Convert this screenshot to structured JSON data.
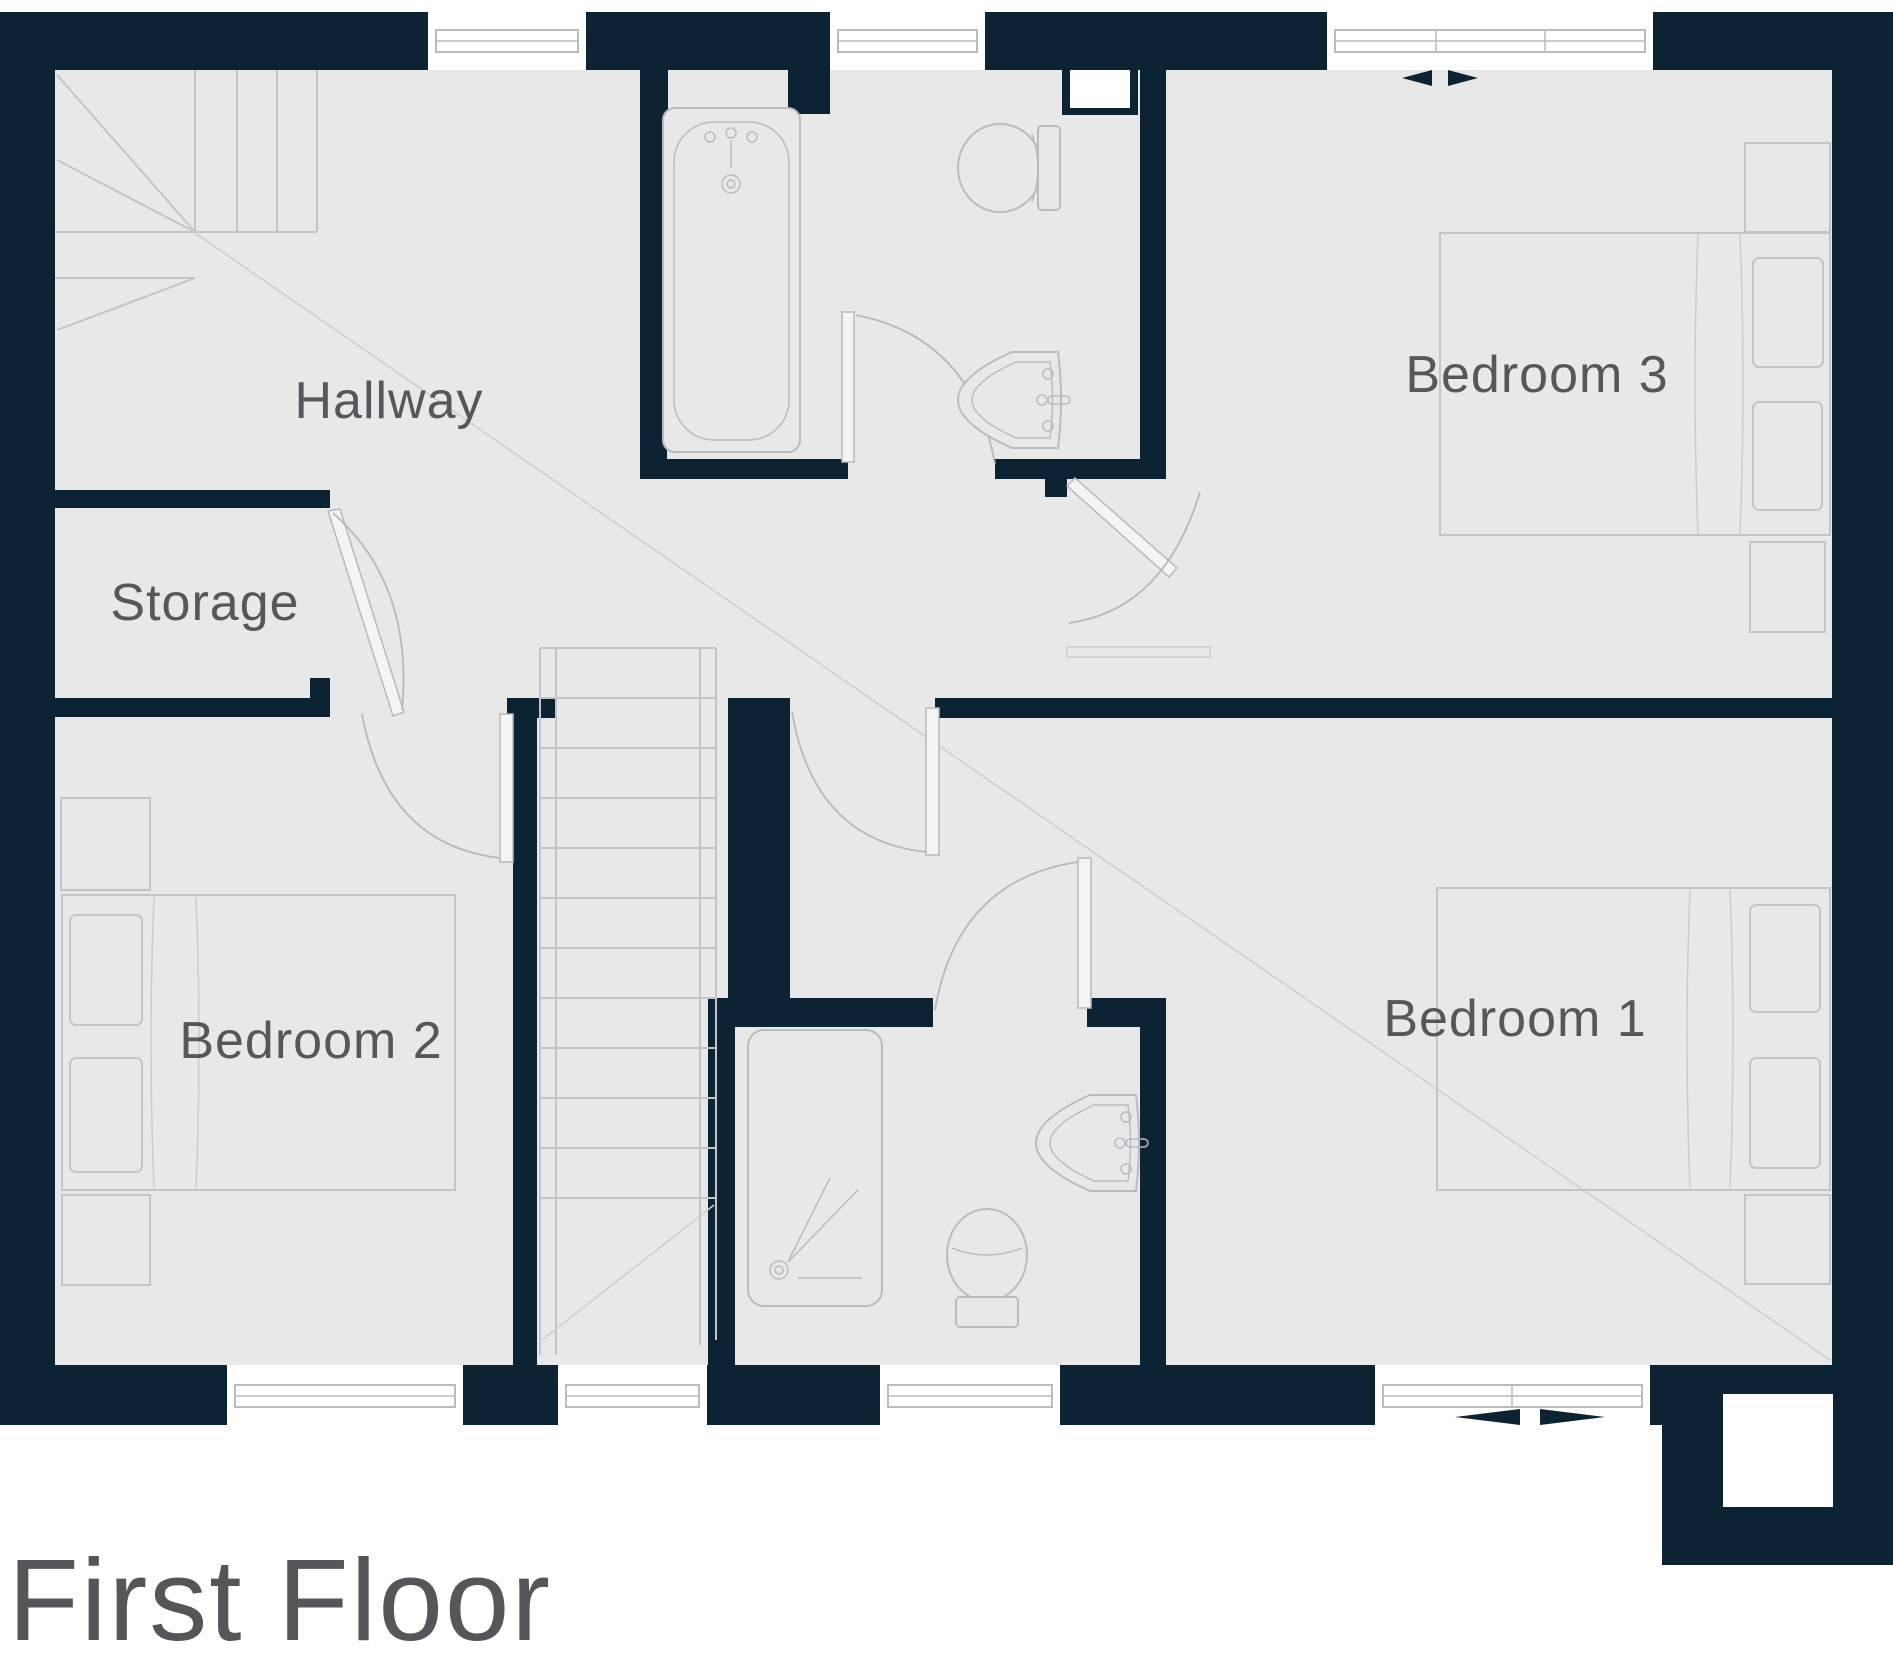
{
  "title": "First Floor",
  "rooms": {
    "hallway": {
      "label": "Hallway"
    },
    "storage": {
      "label": "Storage"
    },
    "bedroom1": {
      "label": "Bedroom 1"
    },
    "bedroom2": {
      "label": "Bedroom 2"
    },
    "bedroom3": {
      "label": "Bedroom 3"
    }
  },
  "colors": {
    "wall": "#0b2332",
    "floor": "#e8e8e9",
    "furniture_line": "#c2c5c8",
    "fixture_line": "#b9bcbf",
    "label_text": "#55575a",
    "title_text": "#545659",
    "background": "#ffffff"
  }
}
